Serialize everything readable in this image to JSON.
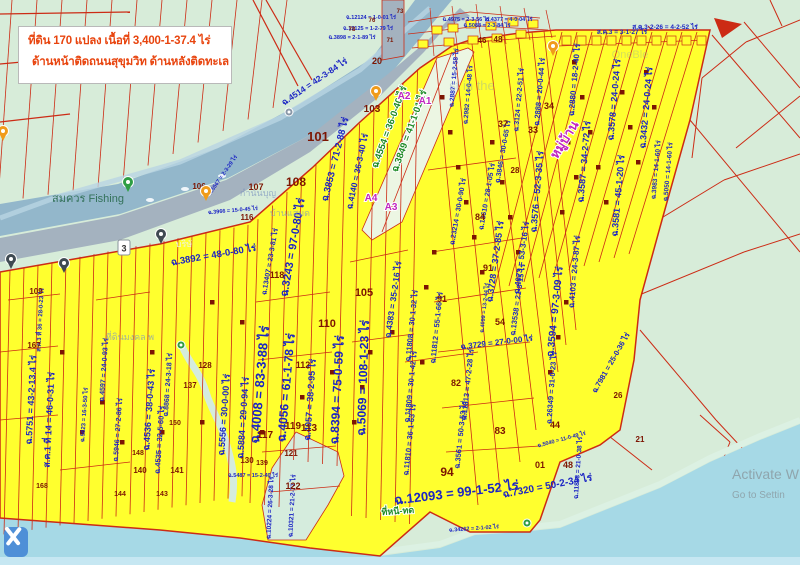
{
  "info_box": {
    "line1": "ที่ดิน 170 แปลง เนื้อที่ 3,400-1-37.4 ไร่",
    "line2": "ด้านหน้าติดถนนสุขุมวิท ด้านหลังติดทะเล"
  },
  "watermark": {
    "line1": "Activate W",
    "line2": "Go to Settin"
  },
  "colors": {
    "land": "#d7ecd9",
    "sea": "#a6d9e6",
    "sea_light": "#c6e7f2",
    "river": "#93b7cb",
    "road": "#a4b2bf",
    "parcel_yellow": "#ffff2e",
    "boundary_red": "#cc2b15",
    "deed_blue": "#1b24c4",
    "parcel_number_maroon": "#7c1502",
    "green_label": "#1d8a26",
    "purple_label": "#c026c0",
    "place_teal": "#2e6e54",
    "faint_place": "#7d95c0",
    "pin_orange": "#f09b1a",
    "pin_green": "#2e9e44",
    "pin_black": "#3f4a52",
    "info_text_red": "#e8440e",
    "edit_button_blue": "#4e8fd7"
  },
  "map": {
    "shield": {
      "label": "3",
      "x": 124,
      "y": 248
    },
    "area_labels": [
      {
        "t": "ฉ.4514 = 42-3-84 ไร่",
        "x": 316,
        "y": 84,
        "r": -34,
        "s": 8.5
      },
      {
        "t": "ฉ.3853 = 71-2-88 ไร่",
        "x": 338,
        "y": 160,
        "r": -76,
        "s": 9.5
      },
      {
        "t": "ฉ.4140 = 36-3-40 ไร่",
        "x": 360,
        "y": 172,
        "r": -78,
        "s": 8.5
      },
      {
        "t": "ฉ.3243 = 97-0-80 ไร่",
        "x": 296,
        "y": 248,
        "r": -80,
        "s": 11
      },
      {
        "t": "ฉ.3892 = 48-0-80 ไร่",
        "x": 214,
        "y": 258,
        "r": -10,
        "s": 9.5
      },
      {
        "t": "ฉ.13407 = 23-3-81 ไร่",
        "x": 272,
        "y": 262,
        "r": -80,
        "s": 7
      },
      {
        "t": "ฉ.4383 = 35-2-16 ไร่",
        "x": 396,
        "y": 300,
        "r": -82,
        "s": 8.5
      },
      {
        "t": "ฉ.23214 = 30-0-90 ไร่",
        "x": 460,
        "y": 212,
        "r": -80,
        "s": 7
      },
      {
        "t": "ฉ.13610 = 28-1-05 ไร่",
        "x": 489,
        "y": 197,
        "r": -80,
        "s": 7
      },
      {
        "t": "ฉ.3846 = 30-0-65 ไร่",
        "x": 505,
        "y": 152,
        "r": -80,
        "s": 7
      },
      {
        "t": "ฉ.3728 = 37-2-85 ไร่",
        "x": 498,
        "y": 262,
        "r": -82,
        "s": 9
      },
      {
        "t": "ฉ.4073 = 53-3-16 ไร่",
        "x": 524,
        "y": 258,
        "r": -82,
        "s": 8
      },
      {
        "t": "ฉ.13538 = 21-3-15 ไร่",
        "x": 520,
        "y": 300,
        "r": -82,
        "s": 7.5
      },
      {
        "t": "ฉ.3594 = 97-3-09 ไร่",
        "x": 558,
        "y": 312,
        "r": -84,
        "s": 10
      },
      {
        "t": "ฉ.3576 = 52-3-35 ไร่",
        "x": 540,
        "y": 192,
        "r": -85,
        "s": 9
      },
      {
        "t": "ฉ.3587 = 34-2-72 ไร่",
        "x": 587,
        "y": 162,
        "r": -85,
        "s": 9
      },
      {
        "t": "ฉ.3581 = 45-1-20 ไร่",
        "x": 621,
        "y": 196,
        "r": -85,
        "s": 9
      },
      {
        "t": "ฉ.3983 = 14-1-60 ไร่",
        "x": 658,
        "y": 170,
        "r": -85,
        "s": 6.5
      },
      {
        "t": "ฉ.5050 = 14-1-60 ไร่",
        "x": 670,
        "y": 172,
        "r": -85,
        "s": 6.5
      },
      {
        "t": "ฉ.4103 = 24-3-87 ไร่",
        "x": 577,
        "y": 272,
        "r": -85,
        "s": 8
      },
      {
        "t": "ฉ.2880 = 18-2-40 ไร่",
        "x": 577,
        "y": 80,
        "r": -85,
        "s": 8
      },
      {
        "t": "ฉ.3578 = 24-0-24 ไร่",
        "x": 617,
        "y": 100,
        "r": -85,
        "s": 9
      },
      {
        "t": "ฉ.3432 = 24-0-24 ไร่",
        "x": 649,
        "y": 108,
        "r": -85,
        "s": 9
      },
      {
        "t": "ฉ.2888 = 20-0-44 ไร่",
        "x": 542,
        "y": 92,
        "r": -85,
        "s": 7.5
      },
      {
        "t": "ฉ.3124 = 22-2-51 ไร่",
        "x": 521,
        "y": 100,
        "r": -85,
        "s": 7
      },
      {
        "t": "ฉ.2887 = 15-2-58 ไร่",
        "x": 456,
        "y": 78,
        "r": -85,
        "s": 6.5
      },
      {
        "t": "ฉ.2982 = 14-0-48 ไร่",
        "x": 470,
        "y": 95,
        "r": -85,
        "s": 6.5
      },
      {
        "t": "ส.ค.3 = 3-1-27 ไร่",
        "x": 622,
        "y": 34,
        "r": 0,
        "s": 6.5
      },
      {
        "t": "ส.ค.3-2-26 = 4-2-52 ไร่",
        "x": 665,
        "y": 29,
        "r": 0,
        "s": 6.5
      },
      {
        "t": "ฉ.5751 = 43-2-13.4 ไร่",
        "x": 34,
        "y": 400,
        "r": -87,
        "s": 9
      },
      {
        "t": "ส.ค.1 ที่ 14 = 46-0-31 ไร่",
        "x": 52,
        "y": 420,
        "r": -87,
        "s": 9
      },
      {
        "t": "ฉ.4008 = 83-3-88 ไร่",
        "x": 264,
        "y": 385,
        "r": -85,
        "s": 13
      },
      {
        "t": "ฉ.4056 = 61-1-78 ไร่",
        "x": 290,
        "y": 388,
        "r": -85,
        "s": 12
      },
      {
        "t": "ฉ.4057 = 38-2-95 ไร่",
        "x": 313,
        "y": 400,
        "r": -86,
        "s": 9
      },
      {
        "t": "ฉ.8394 = 75-0-59 ไร่",
        "x": 341,
        "y": 390,
        "r": -87,
        "s": 12
      },
      {
        "t": "ฉ.5069 = 108-1-23 ไร่",
        "x": 367,
        "y": 378,
        "r": -88,
        "s": 12
      },
      {
        "t": "ฉ.5556 = 30-0-00 ไร่",
        "x": 227,
        "y": 415,
        "r": -86,
        "s": 9
      },
      {
        "t": "ฉ.5884 = 29-0-94 ไร่",
        "x": 246,
        "y": 418,
        "r": -86,
        "s": 9
      },
      {
        "t": "ฉ.4536 = 38-0-43 ไร่",
        "x": 152,
        "y": 410,
        "r": -86,
        "s": 9
      },
      {
        "t": "ฉ.4535 = 32-5-60 ไร่",
        "x": 162,
        "y": 440,
        "r": -86,
        "s": 7.5
      },
      {
        "t": "ฉ.8868 = 24-3-18 ไร่",
        "x": 170,
        "y": 385,
        "r": -86,
        "s": 7
      },
      {
        "t": "ฉ.4597 = 24-0-93 ไร่",
        "x": 106,
        "y": 370,
        "r": -86,
        "s": 7
      },
      {
        "t": "ฉ.5946 = 27-2-86 ไร่",
        "x": 120,
        "y": 430,
        "r": -86,
        "s": 7
      },
      {
        "t": "ฉ.5623 = 16-3-50 ไร่",
        "x": 86,
        "y": 415,
        "r": -86,
        "s": 6
      },
      {
        "t": "ฉ.12093 = 99-1-52 ไร่",
        "x": 457,
        "y": 497,
        "r": -7,
        "s": 13
      },
      {
        "t": "ฉ.11808 = 30-1-32 ไร่",
        "x": 414,
        "y": 326,
        "r": -84,
        "s": 7.5
      },
      {
        "t": "ฉ.11809 = 30-1-42 ไร่",
        "x": 413,
        "y": 387,
        "r": -84,
        "s": 7.5
      },
      {
        "t": "ฉ.11810 = 36-1-63 ไร่",
        "x": 412,
        "y": 440,
        "r": -84,
        "s": 7.5
      },
      {
        "t": "ฉ.11812 = 55-1-66 ไร่",
        "x": 439,
        "y": 328,
        "r": -84,
        "s": 7.5
      },
      {
        "t": "ฉ.11813 = 47-2-28 ไร่",
        "x": 470,
        "y": 385,
        "r": -84,
        "s": 7.5
      },
      {
        "t": "ฉ.3561 = 50-3-53 ไร่",
        "x": 463,
        "y": 435,
        "r": -84,
        "s": 7.5
      },
      {
        "t": "ฉ.3729 = 27-0-00 ไร่",
        "x": 497,
        "y": 345,
        "r": -7,
        "s": 8
      },
      {
        "t": "ฉ.7320 = 50-2-34 ไร่",
        "x": 548,
        "y": 489,
        "r": -11,
        "s": 10
      },
      {
        "t": "ฉ.26349 = 31-0-23 ไร่",
        "x": 554,
        "y": 388,
        "r": -86,
        "s": 7.5
      },
      {
        "t": "ฉ.7981 = 25-0-36 ไร่",
        "x": 613,
        "y": 364,
        "r": -60,
        "s": 7.5
      },
      {
        "t": "ฉ.11833 = 21-0-38 ไร่",
        "x": 580,
        "y": 468,
        "r": -86,
        "s": 6.5
      },
      {
        "t": "ฉ.5040 = 11-0-49 ไร่",
        "x": 562,
        "y": 441,
        "r": -15,
        "s": 5.5
      },
      {
        "t": "ฉ.4099 = 13-2-44 ไร่",
        "x": 486,
        "y": 308,
        "r": -84,
        "s": 5.5
      },
      {
        "t": "ฉ.10224 = 26-3-28 ไร่",
        "x": 272,
        "y": 508,
        "r": -87,
        "s": 6.5
      },
      {
        "t": "ฉ.10321 = 21-2-77 ไร่",
        "x": 294,
        "y": 506,
        "r": -87,
        "s": 6.5
      },
      {
        "t": "ฉ.3966 = 15-0-45 ไร่",
        "x": 233,
        "y": 212,
        "r": -5,
        "s": 5.5
      },
      {
        "t": "ฉ.5567 = 2-3-29 ไร่",
        "x": 224,
        "y": 176,
        "r": -55,
        "s": 5.5
      },
      {
        "t": "ฉ.34262 = 2-1-02 ไร่",
        "x": 474,
        "y": 530,
        "r": -4,
        "s": 5.5
      },
      {
        "t": "ฉ.12124 = 1-0-01 ไร่",
        "x": 371,
        "y": 19,
        "r": 0,
        "s": 5.5
      },
      {
        "t": "ฉ.12125 = 1-2-79 ไร่",
        "x": 368,
        "y": 30,
        "r": 0,
        "s": 5.5
      },
      {
        "t": "ฉ.3898 = 2-1-89 ไร่",
        "x": 352,
        "y": 39,
        "r": 0,
        "s": 5.5
      },
      {
        "t": "ฉ.4975 = 2-3-56 ไร่",
        "x": 466,
        "y": 21,
        "r": 0,
        "s": 5.5
      },
      {
        "t": "ฉ.5088 = 2-3-84 ไร่",
        "x": 487,
        "y": 27,
        "r": 0,
        "s": 5.5
      },
      {
        "t": "ฉ.4377 = 4-0-04 ไร่",
        "x": 509,
        "y": 21,
        "r": 0,
        "s": 5.5
      },
      {
        "t": "ฉ.5487 = 15-2-40 ไร่",
        "x": 253,
        "y": 477,
        "r": 0,
        "s": 5.5
      },
      {
        "t": "ส.ค.3 ที่ 36 = 28-0-23 ไร่",
        "x": 42,
        "y": 320,
        "r": -87,
        "s": 6
      }
    ],
    "green_labels": [
      {
        "t": "ฉ.4554 = 36-0-40 ไร่",
        "x": 392,
        "y": 128,
        "r": -70,
        "s": 9.5
      },
      {
        "t": "ฉ.3849 = 41-1-01 ไร่",
        "x": 412,
        "y": 132,
        "r": -70,
        "s": 9.5
      },
      {
        "t": "ที่หนี-ทด",
        "x": 398,
        "y": 514,
        "r": -4,
        "s": 9
      }
    ],
    "purple_labels": [
      {
        "t": "หมู่บ้าน",
        "x": 568,
        "y": 142,
        "r": -58,
        "s": 13
      },
      {
        "t": "A2",
        "x": 404,
        "y": 99,
        "r": 0,
        "s": 10
      },
      {
        "t": "A1",
        "x": 425,
        "y": 104,
        "r": 0,
        "s": 10
      },
      {
        "t": "A4",
        "x": 371,
        "y": 201,
        "r": 0,
        "s": 10
      },
      {
        "t": "A3",
        "x": 391,
        "y": 210,
        "r": 0,
        "s": 10
      }
    ],
    "place_labels": [
      {
        "t": "สมควร Fishing",
        "x": 88,
        "y": 202,
        "s": 11,
        "c": "#2e6e54",
        "o": 0.95
      },
      {
        "t": "กำนันบุญ",
        "x": 258,
        "y": 196,
        "s": 9,
        "c": "#7d95c0",
        "o": 0.7
      },
      {
        "t": "บ้านแสมด",
        "x": 290,
        "y": 216,
        "s": 9,
        "c": "#7d95c0",
        "o": 0.7
      },
      {
        "t": "บริษั",
        "x": 184,
        "y": 247,
        "s": 9,
        "c": "#eef2f7",
        "o": 0.9
      },
      {
        "t": "ที่ดินมงคล พ",
        "x": 130,
        "y": 340,
        "s": 9,
        "c": "#7d95c0",
        "o": 0.7
      },
      {
        "t": "st in the",
        "x": 472,
        "y": 90,
        "s": 13,
        "c": "#7a99bb",
        "o": 0.35
      },
      {
        "t": "OneBle",
        "x": 630,
        "y": 58,
        "s": 11,
        "c": "#7a99bb",
        "o": 0.3
      }
    ],
    "parcel_numbers": [
      {
        "n": "101",
        "x": 318,
        "y": 141,
        "s": 13
      },
      {
        "n": "103",
        "x": 372,
        "y": 112,
        "s": 10
      },
      {
        "n": "20",
        "x": 377,
        "y": 64,
        "s": 9
      },
      {
        "n": "108",
        "x": 296,
        "y": 186,
        "s": 12
      },
      {
        "n": "107",
        "x": 256,
        "y": 190,
        "s": 9
      },
      {
        "n": "106",
        "x": 199,
        "y": 189,
        "s": 8
      },
      {
        "n": "116",
        "x": 247,
        "y": 220,
        "s": 8
      },
      {
        "n": "118",
        "x": 277,
        "y": 278,
        "s": 9
      },
      {
        "n": "110",
        "x": 327,
        "y": 327,
        "s": 11
      },
      {
        "n": "105",
        "x": 364,
        "y": 296,
        "s": 11
      },
      {
        "n": "112",
        "x": 303,
        "y": 368,
        "s": 9
      },
      {
        "n": "119",
        "x": 293,
        "y": 429,
        "s": 10
      },
      {
        "n": "113",
        "x": 309,
        "y": 431,
        "s": 10
      },
      {
        "n": "117",
        "x": 265,
        "y": 438,
        "s": 10
      },
      {
        "n": "121",
        "x": 291,
        "y": 456,
        "s": 8
      },
      {
        "n": "122",
        "x": 293,
        "y": 489,
        "s": 9
      },
      {
        "n": "94",
        "x": 447,
        "y": 476,
        "s": 12
      },
      {
        "n": "82",
        "x": 456,
        "y": 386,
        "s": 9
      },
      {
        "n": "83",
        "x": 500,
        "y": 434,
        "s": 10
      },
      {
        "n": "84",
        "x": 480,
        "y": 220,
        "s": 9
      },
      {
        "n": "54",
        "x": 500,
        "y": 325,
        "s": 9
      },
      {
        "n": "91",
        "x": 442,
        "y": 302,
        "s": 9
      },
      {
        "n": "91",
        "x": 488,
        "y": 271,
        "s": 9
      },
      {
        "n": "46",
        "x": 482,
        "y": 43,
        "s": 8
      },
      {
        "n": "48",
        "x": 498,
        "y": 42,
        "s": 8
      },
      {
        "n": "37",
        "x": 503,
        "y": 127,
        "s": 9
      },
      {
        "n": "33",
        "x": 533,
        "y": 133,
        "s": 9
      },
      {
        "n": "34",
        "x": 549,
        "y": 109,
        "s": 9
      },
      {
        "n": "28",
        "x": 515,
        "y": 173,
        "s": 8
      },
      {
        "n": "26",
        "x": 618,
        "y": 398,
        "s": 8
      },
      {
        "n": "21",
        "x": 640,
        "y": 442,
        "s": 8
      },
      {
        "n": "44",
        "x": 555,
        "y": 428,
        "s": 9
      },
      {
        "n": "01",
        "x": 540,
        "y": 468,
        "s": 9
      },
      {
        "n": "48",
        "x": 568,
        "y": 468,
        "s": 9
      },
      {
        "n": "109",
        "x": 36,
        "y": 294,
        "s": 8
      },
      {
        "n": "167",
        "x": 34,
        "y": 348,
        "s": 8
      },
      {
        "n": "137",
        "x": 190,
        "y": 388,
        "s": 8
      },
      {
        "n": "128",
        "x": 205,
        "y": 368,
        "s": 8
      },
      {
        "n": "130",
        "x": 247,
        "y": 463,
        "s": 8
      },
      {
        "n": "139",
        "x": 262,
        "y": 465,
        "s": 7
      },
      {
        "n": "141",
        "x": 177,
        "y": 473,
        "s": 8
      },
      {
        "n": "140",
        "x": 140,
        "y": 473,
        "s": 8
      },
      {
        "n": "144",
        "x": 120,
        "y": 496,
        "s": 7
      },
      {
        "n": "143",
        "x": 162,
        "y": 496,
        "s": 7
      },
      {
        "n": "148",
        "x": 138,
        "y": 455,
        "s": 7
      },
      {
        "n": "150",
        "x": 175,
        "y": 425,
        "s": 7
      },
      {
        "n": "168",
        "x": 42,
        "y": 488,
        "s": 7
      },
      {
        "n": "73",
        "x": 400,
        "y": 13,
        "s": 6
      },
      {
        "n": "76",
        "x": 372,
        "y": 22,
        "s": 6
      },
      {
        "n": "78",
        "x": 352,
        "y": 31,
        "s": 6
      },
      {
        "n": "71",
        "x": 390,
        "y": 42,
        "s": 6
      }
    ],
    "pins": [
      {
        "kind": "black",
        "x": 11,
        "y": 268
      },
      {
        "kind": "black",
        "x": 64,
        "y": 272
      },
      {
        "kind": "black",
        "x": 161,
        "y": 243
      },
      {
        "kind": "green",
        "x": 128,
        "y": 191
      },
      {
        "kind": "orange",
        "x": 206,
        "y": 200
      },
      {
        "kind": "orange",
        "x": 376,
        "y": 100
      },
      {
        "kind": "orange",
        "x": 553,
        "y": 55
      },
      {
        "kind": "orange",
        "x": 3,
        "y": 140
      },
      {
        "kind": "green-small",
        "x": 181,
        "y": 345
      },
      {
        "kind": "green-small",
        "x": 527,
        "y": 523
      },
      {
        "kind": "gray-small",
        "x": 289,
        "y": 112
      }
    ]
  }
}
